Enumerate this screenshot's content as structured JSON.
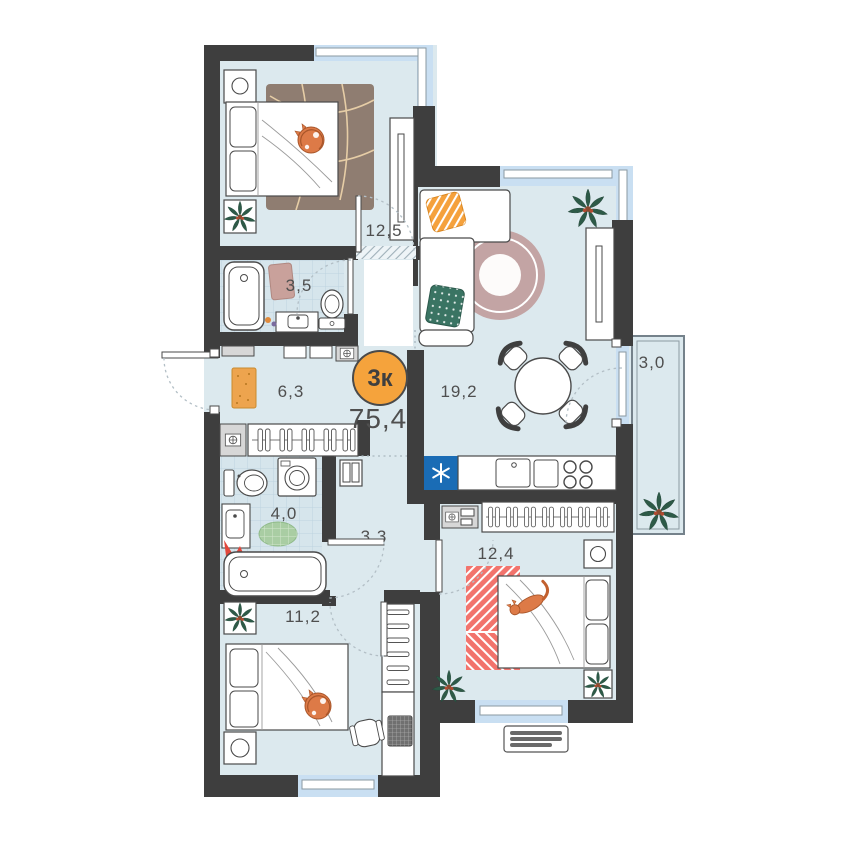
{
  "plan": {
    "badge_label": "3к",
    "total_area": "75,4",
    "rooms": {
      "bedroom_top": {
        "area": "12,5"
      },
      "bathroom_main": {
        "area": "3,5"
      },
      "hallway_entry": {
        "area": "6,3"
      },
      "living_room": {
        "area": "19,2"
      },
      "balcony": {
        "area": "3,0"
      },
      "bathroom_second": {
        "area": "4,0"
      },
      "hallway_inner": {
        "area": "3,3"
      },
      "bedroom_right": {
        "area": "12,4"
      },
      "bedroom_bottom_left": {
        "area": "11,2"
      }
    },
    "colors": {
      "wall": "#3e3e3e",
      "floor": "#dce9ee",
      "windowband": "#c9dff2",
      "accent": "#f5a33c",
      "labeltext": "#4f4f4f",
      "rugbrown": "#8f7d71",
      "rugrose": "#c3a4a4",
      "rugcoral": "#f2736c",
      "pilloworange": "#f5a13c",
      "pillowteal": "#3a7463",
      "fridgeblue": "#1a6cb5",
      "plantgreen": "#2d5a47",
      "catorange": "#dd7a47",
      "matgreen": "#a9cda3",
      "matentry": "#eda44e",
      "towelred": "#e2473b",
      "bathmatpink": "#c9a19b"
    }
  }
}
